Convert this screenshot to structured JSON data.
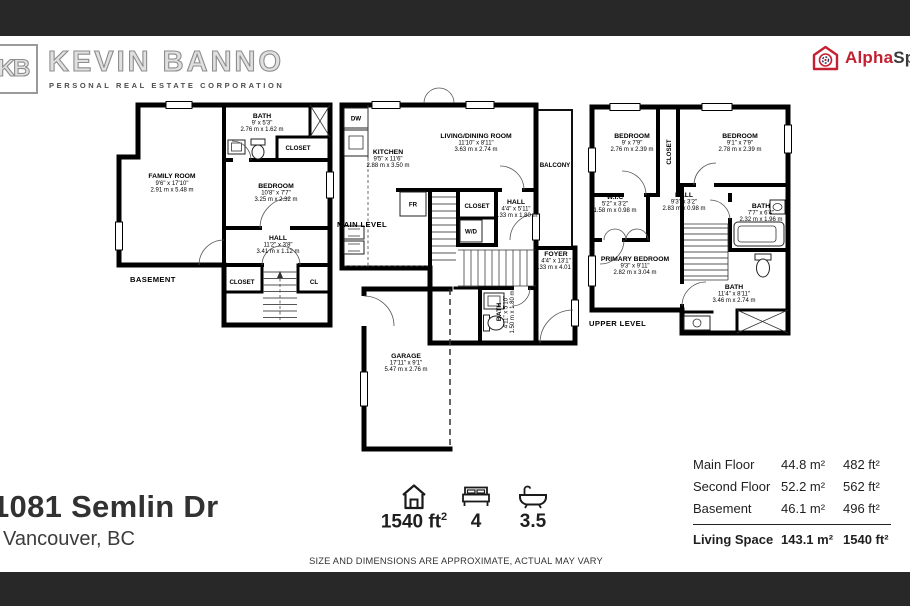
{
  "page": {
    "bar_color": "#282828",
    "accent_red": "#C32131"
  },
  "header": {
    "logo_monogram": "KB",
    "brand_name": "KEVIN BANNO",
    "brand_subtitle": "PERSONAL REAL ESTATE CORPORATION",
    "vendor_logo": {
      "part1": "Alpha",
      "part2": "Space"
    }
  },
  "plans": {
    "basement": {
      "level_label": "BASEMENT",
      "rooms": {
        "family_room": {
          "name": "FAMILY ROOM",
          "dims_ft": "9'6\" x 17'10\"",
          "dims_m": "2.91 m x 5.48 m"
        },
        "bath": {
          "name": "BATH",
          "dims_ft": "9' x 5'3\"",
          "dims_m": "2.76 m x 1.62 m"
        },
        "closet_top": {
          "name": "CLOSET"
        },
        "bedroom": {
          "name": "BEDROOM",
          "dims_ft": "10'8\" x 7'7\"",
          "dims_m": "3.25 m x 2.32 m"
        },
        "hall": {
          "name": "HALL",
          "dims_ft": "11'2\" x 3'8\"",
          "dims_m": "3.41 m x 1.12 m"
        },
        "closet_bottom": {
          "name": "CLOSET"
        },
        "cl": {
          "name": "CL"
        }
      }
    },
    "main": {
      "level_label": "MAIN LEVEL",
      "rooms": {
        "kitchen": {
          "name": "KITCHEN",
          "dims_ft": "9'5\" x 11'6\"",
          "dims_m": "2.88 m x 3.50 m"
        },
        "living_dining": {
          "name": "LIVING/DINING ROOM",
          "dims_ft": "11'10\" x 8'11\"",
          "dims_m": "3.63 m x 2.74 m"
        },
        "balcony": {
          "name": "BALCONY"
        },
        "dw": {
          "name": "DW"
        },
        "fr": {
          "name": "FR"
        },
        "closet": {
          "name": "CLOSET"
        },
        "wd": {
          "name": "W/D"
        },
        "hall": {
          "name": "HALL",
          "dims_ft": "4'4\" x 5'11\"",
          "dims_m": "1.33 m x 1.80 m"
        },
        "foyer": {
          "name": "FOYER",
          "dims_ft": "4'4\" x 13'1\"",
          "dims_m": "1.33 m x 4.01 m"
        },
        "bath": {
          "name": "BATH",
          "dims_ft": "4'11\" x 5'10\"",
          "dims_m": "1.50 m x 1.80 m"
        },
        "garage": {
          "name": "GARAGE",
          "dims_ft": "17'11\" x 9'1\"",
          "dims_m": "5.47 m x 2.76 m"
        }
      }
    },
    "upper": {
      "level_label": "UPPER LEVEL",
      "rooms": {
        "bedroom_left": {
          "name": "BEDROOM",
          "dims_ft": "9' x 7'9\"",
          "dims_m": "2.76 m x 2.39 m"
        },
        "closet": {
          "name": "CLOSET"
        },
        "bedroom_right": {
          "name": "BEDROOM",
          "dims_ft": "9'1\" x 7'9\"",
          "dims_m": "2.78 m x 2.39 m"
        },
        "wic": {
          "name": "W.I.C",
          "dims_ft": "5'2\" x 3'2\"",
          "dims_m": "1.58 m x 0.98 m"
        },
        "hall": {
          "name": "HALL",
          "dims_ft": "9'3\" x 3'2\"",
          "dims_m": "2.83 m x 0.98 m"
        },
        "bath_top": {
          "name": "BATH",
          "dims_ft": "7'7\" x 6'4\"",
          "dims_m": "2.32 m x 1.96 m"
        },
        "primary_bedroom": {
          "name": "PRIMARY BEDROOM",
          "dims_ft": "9'3\" x 9'11\"",
          "dims_m": "2.82 m x 3.04 m"
        },
        "bath_bottom": {
          "name": "BATH",
          "dims_ft": "11'4\" x 8'11\"",
          "dims_m": "3.46 m x 2.74 m"
        }
      }
    }
  },
  "footer": {
    "address_line1": "1081 Semlin Dr",
    "address_line2": "Vancouver, BC",
    "stats": {
      "area_value": "1540 ft",
      "area_sup": "2",
      "beds": "4",
      "baths": "3.5"
    },
    "area_table": {
      "rows": [
        {
          "label": "Main Floor",
          "metric": "44.8 m²",
          "imperial": "482 ft²"
        },
        {
          "label": "Second Floor",
          "metric": "52.2 m²",
          "imperial": "562 ft²"
        },
        {
          "label": "Basement",
          "metric": "46.1 m²",
          "imperial": "496 ft²"
        }
      ],
      "total": {
        "label": "Living Space",
        "metric": "143.1 m²",
        "imperial": "1540 ft²"
      }
    },
    "disclaimer": "SIZE AND DIMENSIONS ARE APPROXIMATE, ACTUAL MAY VARY"
  }
}
